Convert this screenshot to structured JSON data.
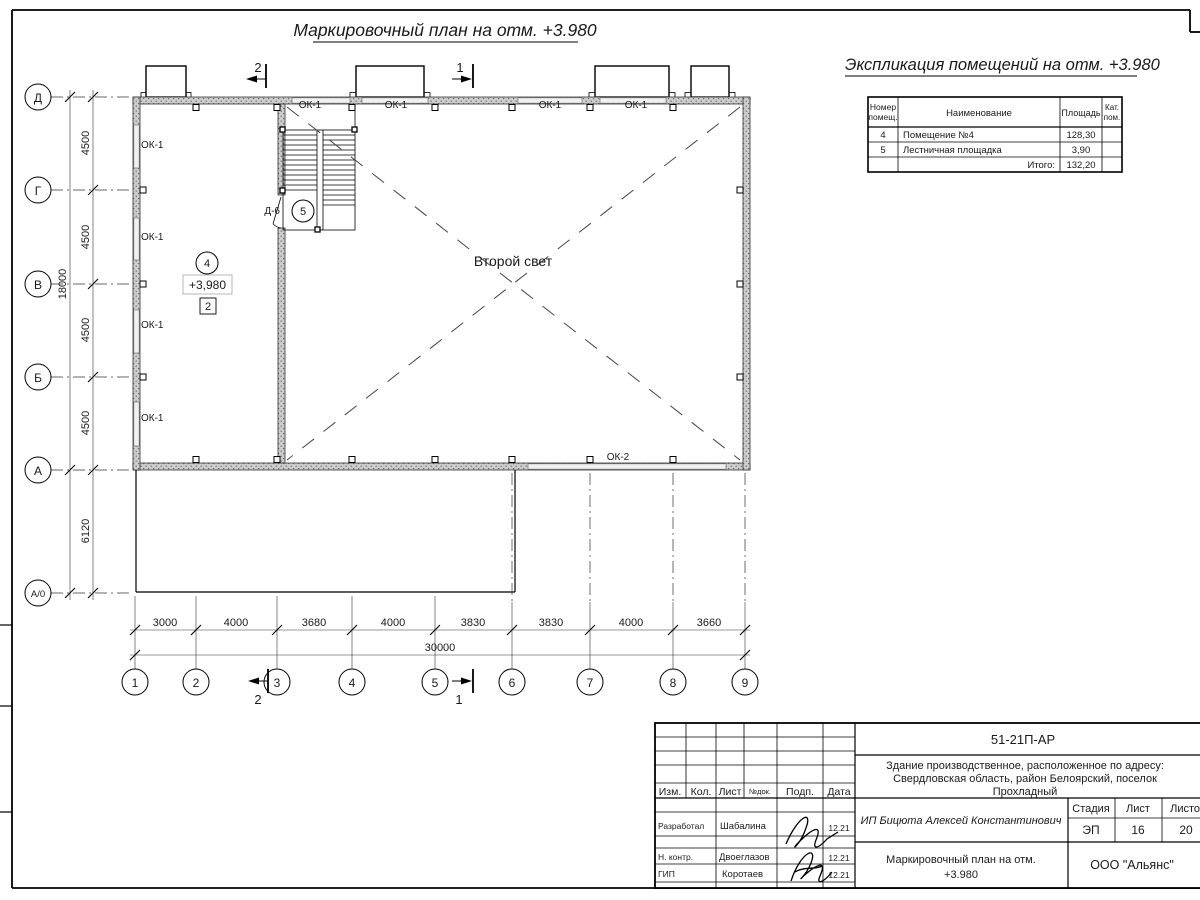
{
  "page": {
    "title": "Маркировочный план на отм. +3.980"
  },
  "explication": {
    "heading": "Экспликация помещений на отм. +3.980",
    "columns": {
      "num1": "Номер",
      "num2": "помещ.",
      "name": "Наименование",
      "area": "Площадь",
      "cat1": "Кат.",
      "cat2": "пом."
    },
    "rows": [
      {
        "num": "4",
        "name": "Помещение №4",
        "area": "128,30"
      },
      {
        "num": "5",
        "name": "Лестничная площадка",
        "area": "3,90"
      }
    ],
    "total_label": "Итого:",
    "total_value": "132,20"
  },
  "axes": {
    "rows": [
      "Д",
      "Г",
      "В",
      "Б",
      "А",
      "А/0"
    ],
    "cols": [
      "1",
      "2",
      "3",
      "4",
      "5",
      "6",
      "7",
      "8",
      "9"
    ]
  },
  "dims": {
    "left": [
      "4500",
      "4500",
      "4500",
      "4500",
      "6120"
    ],
    "left_total": "18000",
    "bottom": [
      "3000",
      "4000",
      "3680",
      "4000",
      "3830",
      "3830",
      "4000",
      "3660"
    ],
    "bottom_total": "30000"
  },
  "plan": {
    "second_light": "Второй свет",
    "room4": "4",
    "room5": "5",
    "elevation_mark": "+3,980",
    "zone_mark": "2",
    "door_mark": "Д-6",
    "window_ok1": "ОК-1",
    "window_ok2": "ОК-2"
  },
  "sections": {
    "s1": "1",
    "s2": "2"
  },
  "titleblock": {
    "doc_code": "51-21П-АР",
    "address": [
      "Здание производственное, расположенное по адресу:",
      "Свердловская область, район Белоярский, поселок",
      "Прохладный"
    ],
    "header": {
      "izm": "Изм.",
      "kol": "Кол.",
      "list": "Лист",
      "doc": "№док.",
      "podp": "Подп.",
      "data": "Дата"
    },
    "rows": [
      {
        "role": "Разработал",
        "name": "Шабалина",
        "date": "12.21"
      },
      {
        "role": "Н. контр.",
        "name": "Двоеглазов",
        "date": "12.21"
      },
      {
        "role": "ГИП",
        "name": "Коротаев",
        "date": "12.21"
      }
    ],
    "client": "ИП Бицюта Алексей Константинович",
    "stage_label": "Стадия",
    "sheet_label": "Лист",
    "sheets_label": "Листов",
    "stage": "ЭП",
    "sheet": "16",
    "sheets": "20",
    "doc_title1": "Маркировочный план на отм.",
    "doc_title2": "+3.980",
    "company": "ООО \"Альянс\""
  }
}
